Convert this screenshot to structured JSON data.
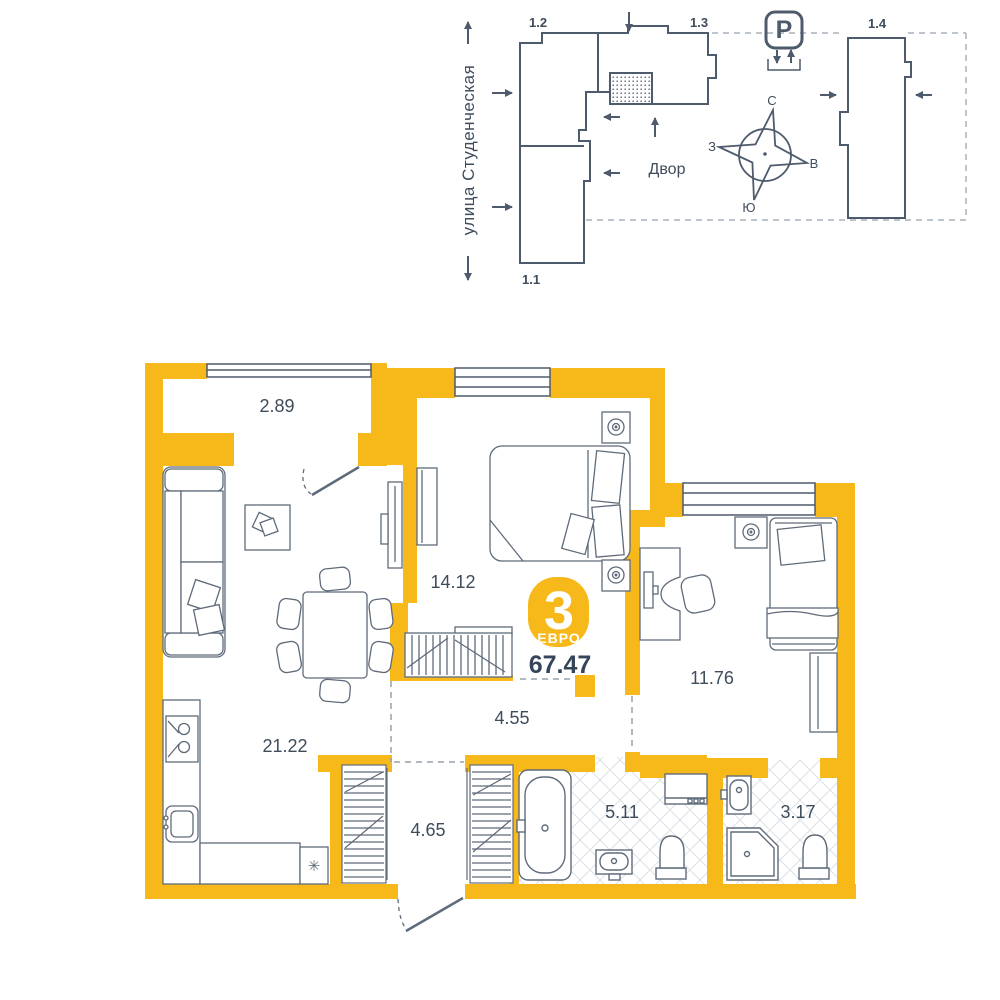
{
  "site_plan": {
    "street_label": "улица Студенческая",
    "courtyard_label": "Двор",
    "parking_label": "P",
    "buildings": {
      "b12": "1.2",
      "b13": "1.3",
      "b14": "1.4",
      "b11": "1.1"
    },
    "compass": {
      "north": "С",
      "east": "В",
      "south": "Ю",
      "west": "З"
    }
  },
  "apartment": {
    "badge": {
      "rooms_count": "3",
      "layout_type": "ЕВРО",
      "total_area": "67.47"
    },
    "rooms": {
      "balcony": {
        "label": "2.89"
      },
      "bedroom": {
        "label": "14.12"
      },
      "kitchen_living": {
        "label": "21.22"
      },
      "bedroom2": {
        "label": "11.76"
      },
      "hallway": {
        "label": "4.55"
      },
      "entrance_hall": {
        "label": "4.65"
      },
      "bathroom": {
        "label": "5.11"
      },
      "shower_room": {
        "label": "3.17"
      }
    },
    "fridge_symbol": "✳"
  },
  "colors": {
    "wall_accent": "#F7B81A",
    "line": "#4E5B6C",
    "furniture_line": "#5F6B7A",
    "text": "#3E4C5C",
    "dash": "#A9B1BA",
    "tile_line": "#DCE1E7"
  }
}
